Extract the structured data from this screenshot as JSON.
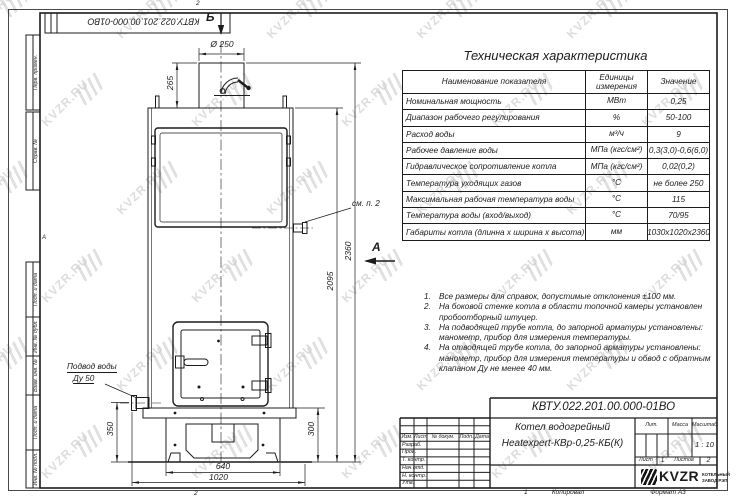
{
  "sheet": {
    "zone_top": "2",
    "zone_bottom": "2",
    "zone_bottom_num": "1",
    "zone_letter": "А",
    "copied_label": "Копировал",
    "format_label": "Формат А3"
  },
  "stamp_top": "КВТУ.022.201.00.000-01ВО",
  "margin_labels": [
    "Перв. примен.",
    "Справ. №",
    "Подп. и дата",
    "Инв. № дубл.",
    "Взам. инв. №",
    "Подп. и дата",
    "Инв. № подл."
  ],
  "view_markers": {
    "b": "Б",
    "a": "А"
  },
  "drawing": {
    "dims": {
      "d250": "Ø 250",
      "h265": "265",
      "h2095": "2095",
      "h2360": "2360",
      "h350": "350",
      "h300": "300",
      "w640": "640",
      "w1020": "1020"
    },
    "labels": {
      "see_note": "см. п. 2",
      "water_line1": "Подвод воды",
      "water_line2": "Ду 50"
    }
  },
  "tech_table": {
    "title": "Техническая характеристика",
    "headers": {
      "name": "Наименование показателя",
      "units": "Единицы измерения",
      "value": "Значение"
    },
    "rows": [
      {
        "name": "Номинальная мощность",
        "units": "МВт",
        "value": "0,25"
      },
      {
        "name": "Диапазон рабочего регулирования",
        "units": "%",
        "value": "50-100"
      },
      {
        "name": "Расход воды",
        "units": "м³/ч",
        "value": "9"
      },
      {
        "name": "Рабочее давление воды",
        "units": "МПа (кгс/см²)",
        "value": "0,3(3,0)-0,6(6,0)"
      },
      {
        "name": "Гидравлическое сопротивление котла",
        "units": "МПа (кгс/см²)",
        "value": "0,02(0,2)"
      },
      {
        "name": "Температура уходящих газов",
        "units": "°С",
        "value": "не более 250"
      },
      {
        "name": "Максимальная рабочая температура воды",
        "units": "°С",
        "value": "115"
      },
      {
        "name": "Температура воды (вход/выход)",
        "units": "°С",
        "value": "70/95"
      },
      {
        "name": "Габариты котла (длинна х ширина х высота)",
        "units": "мм",
        "value": "1030х1020х2360"
      }
    ]
  },
  "notes": [
    {
      "num": "1.",
      "text": "Все размеры для справок, допустимые отклонения ±100 мм."
    },
    {
      "num": "2.",
      "text": "На боковой стенке котла в области топочной камеры установлен пробоотборный штуцер."
    },
    {
      "num": "3.",
      "text": "На подводящей трубе котла, до запорной арматуры установлены: манометр, прибор для измерения температуры."
    },
    {
      "num": "4.",
      "text": "На отводящей трубе котла, до запорной арматуры установлены: манометр, прибор для измерения температуры и обвод с обратным клапаном Ду не менее 40 мм."
    }
  ],
  "title_block": {
    "doc_number": "КВТУ.022.201.00.000-01ВО",
    "product_name_1": "Котел водогрейный",
    "product_name_2": "Heatexpert-КВр-0,25-КБ(К)",
    "header_cols": [
      "Изм.",
      "Лист",
      "№ докум.",
      "Подп.",
      "Дата"
    ],
    "row_labels": [
      "Разраб.",
      "Пров.",
      "Т. контр.",
      "Нач.отд.",
      "Н. контр.",
      "Утв."
    ],
    "lit_label": "Лит.",
    "mass_label": "Масса",
    "scale_label": "Масштаб",
    "scale_value": "1 : 10",
    "sheet_label": "Лист",
    "sheet_value": "1",
    "sheets_label": "Листов",
    "sheets_value": "2",
    "company": {
      "logo_text": "KVZR",
      "tagline_1": "КОТЕЛЬНЫЙ",
      "tagline_2": "ЗАВОД РЭП"
    }
  },
  "watermark": {
    "text": "KVZR.RU"
  }
}
